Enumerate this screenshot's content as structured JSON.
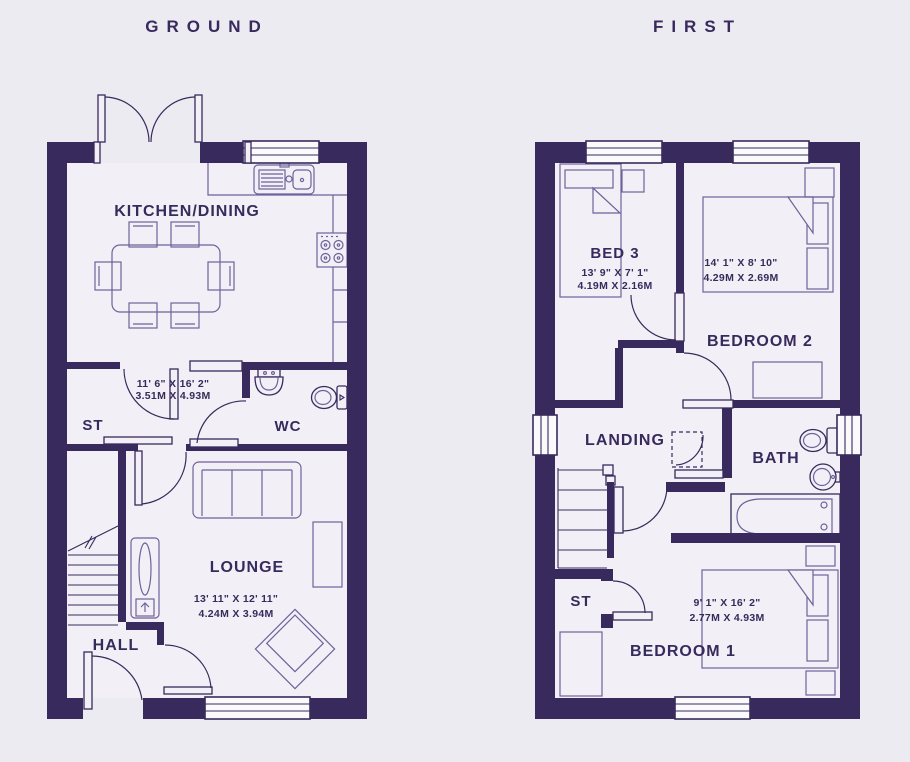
{
  "colors": {
    "background": "#ecebf1",
    "floor_fill": "#f2f0f6",
    "wall": "#382a5c",
    "furniture_line": "#70619b",
    "text": "#382a5c"
  },
  "floors": [
    {
      "title": "GROUND",
      "rooms": [
        {
          "name": "KITCHEN/DINING",
          "dims_imperial": "11' 6\" X 16' 2\"",
          "dims_metric": "3.51M X 4.93M"
        },
        {
          "name": "ST"
        },
        {
          "name": "WC"
        },
        {
          "name": "LOUNGE",
          "dims_imperial": "13' 11\" X 12' 11\"",
          "dims_metric": "4.24M X 3.94M"
        },
        {
          "name": "HALL"
        }
      ]
    },
    {
      "title": "FIRST",
      "rooms": [
        {
          "name": "BED 3",
          "dims_imperial": "13' 9\" X 7' 1\"",
          "dims_metric": "4.19M X 2.16M"
        },
        {
          "name": "BEDROOM 2",
          "dims_imperial": "14' 1\" X 8' 10\"",
          "dims_metric": "4.29M X 2.69M"
        },
        {
          "name": "LANDING"
        },
        {
          "name": "BATH"
        },
        {
          "name": "ST"
        },
        {
          "name": "BEDROOM 1",
          "dims_imperial": "9' 1\" X 16' 2\"",
          "dims_metric": "2.77M X 4.93M"
        }
      ]
    }
  ]
}
